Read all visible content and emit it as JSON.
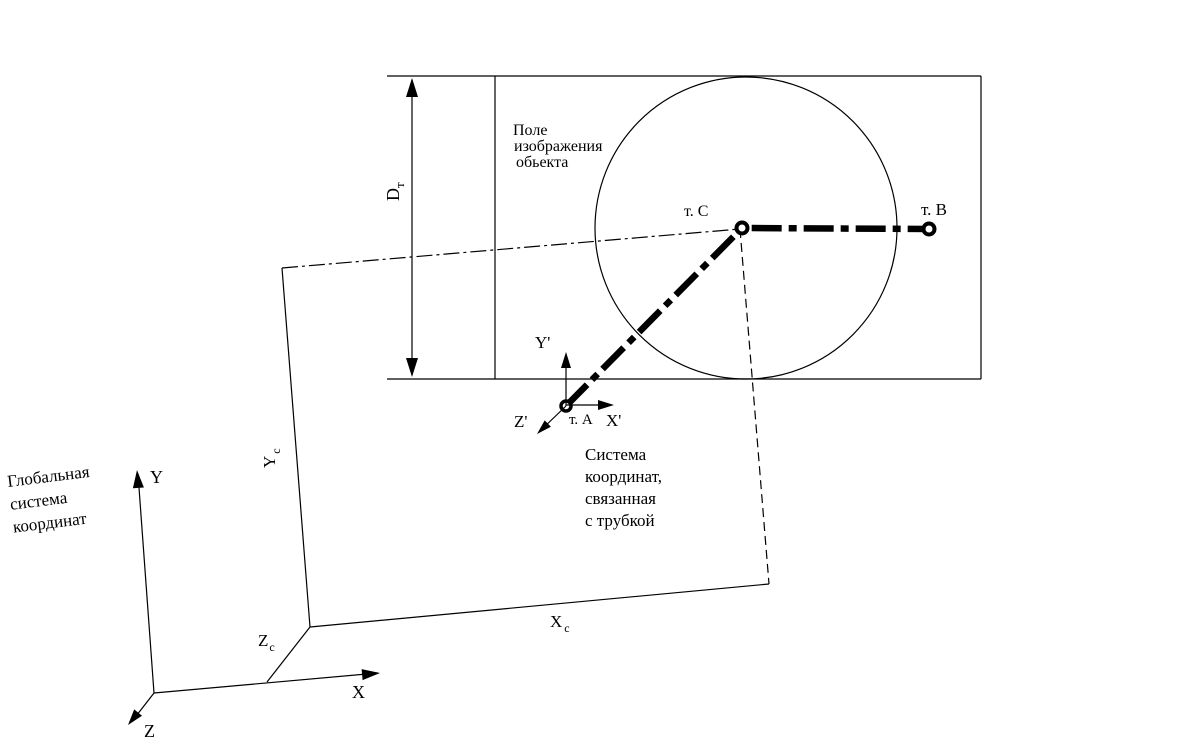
{
  "colors": {
    "ink": "#000000",
    "background": "#ffffff"
  },
  "field_caption": {
    "line1": "Поле",
    "line2": "изображения",
    "line3": "обьекта"
  },
  "points": {
    "a": "т. А",
    "b": "т. В",
    "c": "т. С"
  },
  "dimension": {
    "main": "D",
    "sub": "т"
  },
  "global_axes": {
    "x": "X",
    "y": "Y",
    "z": "Z"
  },
  "global_caption": {
    "line1": "Глобальная",
    "line2": "система",
    "line3": "координат"
  },
  "frame_axes": {
    "x_main": "X",
    "x_sub": "c",
    "y_main": "Y",
    "y_sub": "c",
    "z_main": "Z",
    "z_sub": "c"
  },
  "tube_axes": {
    "x": "X'",
    "y": "Y'",
    "z": "Z'"
  },
  "tube_caption": {
    "line1": "Система",
    "line2": "координат,",
    "line3": "связанная",
    "line4": "с трубкой"
  }
}
